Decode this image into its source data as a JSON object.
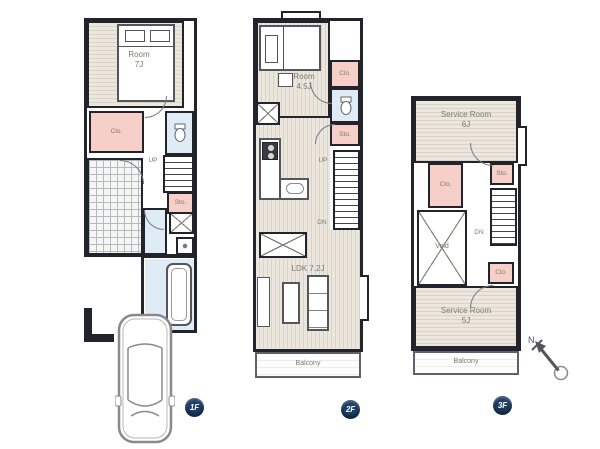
{
  "colors": {
    "wall": "#23232c",
    "closet_pink": "#f6cfc8",
    "wet_area_blue": "#dfecf5",
    "floor_beige": "#ece7de",
    "badge_navy": "#1d3f66"
  },
  "f1": {
    "badge": "1F",
    "room_label": "Room",
    "room_size": "7J",
    "closet": "Clo.",
    "up": "UP",
    "storage": "Sto."
  },
  "f2": {
    "badge": "2F",
    "room_label": "Room",
    "room_size": "4.5J",
    "closet": "Clo.",
    "storage": "Sto.",
    "up": "UP",
    "down": "DN",
    "ldk": "LDK 7.2J",
    "balcony": "Balcony"
  },
  "f3": {
    "badge": "3F",
    "service_top_label": "Service Room",
    "service_top_size": "6J",
    "closet": "Clo.",
    "storage": "Sto.",
    "down": "DN",
    "void": "Void",
    "closet2": "Clo.",
    "service_bottom_label": "Service Room",
    "service_bottom_size": "5J",
    "balcony": "Balcony"
  },
  "compass": {
    "north_label": "N"
  },
  "icons": {
    "bed": "bed-icon",
    "toilet": "toilet-icon",
    "bathtub": "bathtub-icon",
    "washing_machine": "washing-machine-icon",
    "car": "car-icon",
    "north_arrow": "north-arrow-icon",
    "kitchen": "kitchen-counter-icon"
  }
}
